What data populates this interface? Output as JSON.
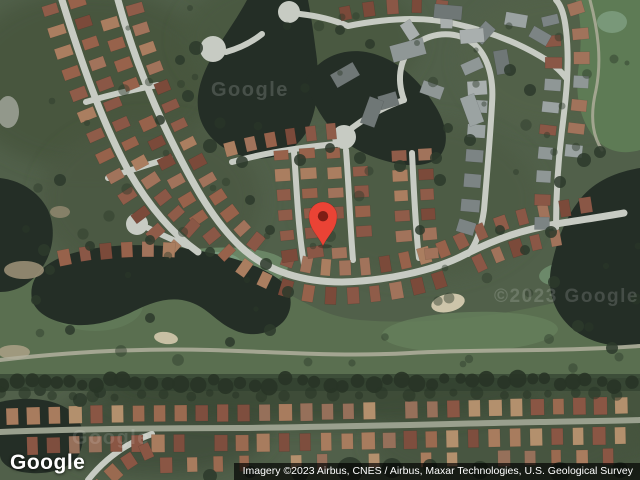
{
  "ui": {
    "logo": {
      "text": "Google"
    },
    "attribution": {
      "text": "Imagery ©2023 Airbus, CNES / Airbus, Maxar Technologies, U.S. Geological Survey"
    },
    "watermarks": [
      {
        "text": "Google",
        "x": 211,
        "y": 79,
        "size": 20,
        "opacity": 0.16
      },
      {
        "text": "©2023 Google",
        "x": 494,
        "y": 286,
        "size": 19,
        "opacity": 0.15
      },
      {
        "text": "Google",
        "x": 72,
        "y": 427,
        "size": 20,
        "opacity": 0.12
      }
    ]
  },
  "map": {
    "provider": "Google",
    "view": "satellite",
    "imagery_year": "2023",
    "marker": {
      "x": 323,
      "y": 216,
      "tip_y": 246,
      "color": "#EA4335",
      "core": "#7E1D15"
    },
    "colors": {
      "base": "#51604a",
      "road": "#c7cbc3",
      "water": "#242e26",
      "golf": "#5a6f50",
      "treeline": "#283426",
      "tree": "#2d3a2b"
    },
    "bgBlobs": [
      {
        "cx": 90,
        "cy": 80,
        "rx": 130,
        "ry": 90,
        "fill": "#47553e"
      },
      {
        "cx": 300,
        "cy": 40,
        "rx": 120,
        "ry": 70,
        "fill": "#4a5841"
      },
      {
        "cx": 560,
        "cy": 60,
        "rx": 100,
        "ry": 70,
        "fill": "#53624a"
      },
      {
        "cx": 420,
        "cy": 200,
        "rx": 120,
        "ry": 80,
        "fill": "#4d5c45"
      },
      {
        "cx": 150,
        "cy": 200,
        "rx": 110,
        "ry": 80,
        "fill": "#4b5943"
      },
      {
        "cx": 600,
        "cy": 420,
        "rx": 90,
        "ry": 55,
        "fill": "#44523d"
      },
      {
        "cx": 160,
        "cy": 430,
        "rx": 110,
        "ry": 45,
        "fill": "#404e3a"
      },
      {
        "cx": 500,
        "cy": 445,
        "rx": 130,
        "ry": 45,
        "fill": "#46543f"
      },
      {
        "cx": 320,
        "cy": 390,
        "rx": 220,
        "ry": 35,
        "fill": "#3b4835"
      }
    ],
    "golfBand": "M0,274 C60,264 120,260 180,264 C240,270 268,282 296,298 C318,310 336,318 360,320 C420,325 480,318 530,308 C570,300 606,291 640,286 L640,378 L0,378 Z",
    "golfStrip": "M576,0 L640,0 L640,150 C620,156 601,150 589,130 C578,112 575,90 579,64 C582,40 581,18 576,0 Z",
    "fairways": [
      {
        "cx": 210,
        "cy": 272,
        "rx": 78,
        "ry": 24,
        "rot": -4,
        "fill": "#6d8968",
        "op": 0.9
      },
      {
        "cx": 470,
        "cy": 332,
        "rx": 88,
        "ry": 20,
        "rot": -2,
        "fill": "#65805b",
        "op": 0.8
      },
      {
        "cx": 95,
        "cy": 305,
        "rx": 48,
        "ry": 26,
        "rot": 0,
        "fill": "#627a59",
        "op": 0.8
      },
      {
        "cx": 565,
        "cy": 274,
        "rx": 26,
        "ry": 12,
        "rot": -6,
        "fill": "#6f8e6e",
        "op": 0.9
      },
      {
        "cx": 205,
        "cy": 265,
        "rx": 36,
        "ry": 13,
        "rot": -4,
        "fill": "#7a9b7d",
        "op": 0.9
      },
      {
        "cx": 612,
        "cy": 22,
        "rx": 15,
        "ry": 11,
        "rot": 0,
        "fill": "#7a9a7b",
        "op": 0.95
      }
    ],
    "water": [
      "M247,0 C230,32 202,62 198,96 C195,125 213,147 242,156 C270,164 297,153 309,127 C318,106 320,80 316,52 C313,28 310,10 308,0 Z",
      "M306,80 C318,58 342,48 366,52 C394,57 418,78 434,104 C446,122 451,144 439,157 C425,170 397,166 371,156 C347,147 329,130 317,108 C311,97 306,88 306,80 Z",
      "M640,168 C615,172 592,182 578,202 C564,220 556,244 551,268 C547,292 554,314 574,330 C594,345 618,348 640,344 Z",
      "M0,178 C18,180 38,190 48,210 C56,228 54,250 42,268 C30,286 14,292 0,292 Z",
      "M32,300 C28,278 44,262 70,254 C102,244 152,242 195,250 C232,256 262,266 281,281 C293,291 294,310 283,322 C271,334 251,338 234,330 C216,322 208,308 190,302 C170,295 150,303 132,312 C114,321 90,328 68,324 C48,320 36,312 32,300 Z",
      "M0,402 C25,396 55,398 72,412 C84,422 86,442 78,456 C68,470 45,476 22,472 C8,469 0,462 0,455 Z"
    ],
    "sand": [
      {
        "cx": 448,
        "cy": 303,
        "rx": 17,
        "ry": 9,
        "rot": -12,
        "fill": "#cdc5aa",
        "op": 1
      },
      {
        "cx": 166,
        "cy": 338,
        "rx": 12,
        "ry": 6,
        "rot": 8,
        "fill": "#c8c0a4",
        "op": 1
      },
      {
        "cx": 24,
        "cy": 270,
        "rx": 20,
        "ry": 9,
        "rot": 0,
        "fill": "#a79a80",
        "op": 0.8
      },
      {
        "cx": 14,
        "cy": 352,
        "rx": 16,
        "ry": 7,
        "rot": 0,
        "fill": "#b0a489",
        "op": 0.8
      },
      {
        "cx": 8,
        "cy": 112,
        "rx": 11,
        "ry": 16,
        "rot": 0,
        "fill": "#9aa094",
        "op": 0.9
      },
      {
        "cx": 60,
        "cy": 212,
        "rx": 10,
        "ry": 6,
        "rot": 0,
        "fill": "#9f9278",
        "op": 0.7
      }
    ],
    "cartPaths": [
      {
        "d": "M0,360 C70,352 140,348 210,350 C280,352 340,357 410,353 C480,349 560,352 640,346",
        "w": 4,
        "c": "#b2b09d",
        "op": 0.85
      },
      {
        "d": "M590,0 C598,30 602,60 596,90 C590,115 592,135 602,150",
        "w": 3,
        "c": "#b2b09d",
        "op": 0.8
      }
    ],
    "palettes": {
      "brown": [
        "#8a5746",
        "#97624b",
        "#7b4a3a",
        "#a1735b",
        "#8f5c49",
        "#aa7e60"
      ],
      "brownTan": [
        "#9a6a50",
        "#a87c5e",
        "#8a5644",
        "#b3906d",
        "#7e4e3e",
        "#96705a"
      ],
      "gray": [
        "#8f9796",
        "#9ba3a2",
        "#7c8484",
        "#a9afae",
        "#6f7776"
      ],
      "grayBrown": [
        "#8f9796",
        "#97624b",
        "#9ba3a2",
        "#8a5746",
        "#7c8484",
        "#a1735b"
      ]
    },
    "roads": [
      {
        "d": "M118,0 C132,52 152,102 174,146 C194,186 214,222 242,248 C268,272 304,282 342,282 C382,281 432,272 466,254 C498,238 522,230 556,224 C580,220 602,217 624,213",
        "w": 7,
        "houses": [
          {
            "off": -14,
            "spacing": 21,
            "size": [
              11,
              16
            ],
            "palette": "brown",
            "range": [
              0.02,
              0.97
            ]
          },
          {
            "off": 14,
            "spacing": 21,
            "size": [
              11,
              16
            ],
            "palette": "brown",
            "range": [
              0.03,
              0.9
            ]
          }
        ]
      },
      {
        "d": "M62,0 C80,58 100,118 128,170 C147,203 170,232 198,252",
        "w": 7,
        "houses": [
          {
            "off": -14,
            "spacing": 22,
            "size": [
              11,
              16
            ],
            "palette": "brown",
            "range": [
              0.02,
              0.95
            ]
          },
          {
            "off": 14,
            "spacing": 22,
            "size": [
              11,
              16
            ],
            "palette": "brown",
            "range": [
              0.02,
              0.95
            ]
          }
        ]
      },
      {
        "d": "M86,102 C112,94 136,89 158,85",
        "w": 6
      },
      {
        "d": "M108,178 C130,170 150,164 170,158",
        "w": 6
      },
      {
        "d": "M188,246 C172,240 158,233 148,228",
        "w": 6
      },
      {
        "d": "M226,52 C240,48 252,42 262,34",
        "w": 6
      },
      {
        "d": "M300,14 C318,16 334,20 348,26",
        "w": 6
      },
      {
        "d": "M348,26 C388,18 424,16 456,24 C488,31 516,42 540,56 C552,63 560,70 566,78",
        "w": 6,
        "houses": [
          {
            "off": -13,
            "spacing": 23,
            "size": [
              11,
              15
            ],
            "palette": "brown",
            "range": [
              0,
              0.4
            ]
          }
        ]
      },
      {
        "d": "M294,152 C297,192 298,228 304,264",
        "w": 6,
        "houses": [
          {
            "off": -13,
            "spacing": 20,
            "size": [
              11,
              15
            ],
            "palette": "brown"
          },
          {
            "off": 13,
            "spacing": 20,
            "size": [
              11,
              15
            ],
            "palette": "brown"
          }
        ]
      },
      {
        "d": "M346,150 C349,188 350,224 353,260",
        "w": 6,
        "houses": [
          {
            "off": -13,
            "spacing": 20,
            "size": [
              11,
              15
            ],
            "palette": "brown"
          },
          {
            "off": 13,
            "spacing": 20,
            "size": [
              11,
              15
            ],
            "palette": "brown"
          }
        ]
      },
      {
        "d": "M232,162 C268,152 304,147 336,144",
        "w": 6,
        "houses": [
          {
            "off": -13,
            "spacing": 20,
            "size": [
              11,
              15
            ],
            "palette": "brown"
          }
        ]
      },
      {
        "d": "M412,153 C414,190 415,224 419,258",
        "w": 6,
        "houses": [
          {
            "off": -13,
            "spacing": 20,
            "size": [
              11,
              15
            ],
            "palette": "brown"
          },
          {
            "off": 13,
            "spacing": 20,
            "size": [
              11,
              15
            ],
            "palette": "brown"
          }
        ]
      },
      {
        "d": "M352,128 C368,116 386,106 404,100",
        "w": 6
      },
      {
        "d": "M404,100 C396,78 400,56 416,44 C434,31 458,31 474,44 C488,56 494,78 492,104",
        "w": 6,
        "houses": [
          {
            "off": 15,
            "spacing": 28,
            "size": [
              13,
              19
            ],
            "palette": "gray",
            "p": 0.8
          },
          {
            "off": -15,
            "spacing": 30,
            "size": [
              13,
              19
            ],
            "palette": "gray",
            "p": 0.6
          }
        ]
      },
      {
        "d": "M492,104 C490,140 487,175 484,210 C481,232 475,246 468,254",
        "w": 6,
        "houses": [
          {
            "off": 14,
            "spacing": 25,
            "size": [
              12,
              18
            ],
            "palette": "gray"
          }
        ]
      },
      {
        "d": "M556,228 C556,196 558,162 562,130 C566,98 570,64 566,30 C564,12 560,4 556,0",
        "w": 6,
        "houses": [
          {
            "off": -14,
            "spacing": 23,
            "size": [
              11,
              16
            ],
            "palette": "grayBrown"
          },
          {
            "off": 14,
            "spacing": 23,
            "size": [
              11,
              16
            ],
            "palette": "grayBrown",
            "range": [
              0.34,
              1
            ]
          }
        ]
      },
      {
        "d": "M0,432 C80,429 160,428 240,428 C340,427 440,424 540,422 C580,421 612,421 640,420",
        "w": 6,
        "color": "#9aa08e",
        "houses": [
          {
            "off": -15,
            "spacing": 21,
            "size": [
              12,
              17
            ],
            "palette": "brownTan"
          },
          {
            "off": 15,
            "spacing": 21,
            "size": [
              12,
              17
            ],
            "palette": "brownTan",
            "range": [
              0.05,
              1
            ]
          }
        ]
      },
      {
        "d": "M88,480 C104,460 124,444 152,434",
        "w": 6,
        "houses": [
          {
            "off": 14,
            "spacing": 22,
            "size": [
              11,
              15
            ],
            "palette": "brownTan"
          }
        ]
      },
      {
        "d": "M130,466 C300,462 470,459 640,456",
        "w": 0,
        "houses": [
          {
            "off": 0,
            "spacing": 26,
            "size": [
              11,
              15
            ],
            "palette": "brownTan",
            "p": 0.72
          }
        ]
      },
      {
        "d": "M62,258 C100,250 140,247 186,251",
        "w": 0,
        "houses": [
          {
            "off": 0,
            "spacing": 21,
            "size": [
              11,
              15
            ],
            "palette": "brown",
            "p": 0.95
          }
        ]
      }
    ],
    "courts": [
      {
        "cx": 137,
        "cy": 224,
        "r": 11
      },
      {
        "cx": 213,
        "cy": 49,
        "r": 13
      },
      {
        "cx": 289,
        "cy": 12,
        "r": 11
      },
      {
        "cx": 344,
        "cy": 137,
        "r": 12
      }
    ],
    "buildings": [
      {
        "x": 345,
        "y": 75,
        "w": 26,
        "h": 15,
        "rot": -30
      },
      {
        "x": 408,
        "y": 50,
        "w": 34,
        "h": 17,
        "rot": -15
      },
      {
        "x": 448,
        "y": 12,
        "w": 28,
        "h": 14,
        "rot": 5
      },
      {
        "x": 472,
        "y": 36,
        "w": 24,
        "h": 14,
        "rot": -5
      },
      {
        "x": 372,
        "y": 112,
        "w": 28,
        "h": 15,
        "rot": -70
      },
      {
        "x": 472,
        "y": 110,
        "w": 30,
        "h": 15,
        "rot": 70
      },
      {
        "x": 432,
        "y": 90,
        "w": 22,
        "h": 13,
        "rot": 20
      },
      {
        "x": 502,
        "y": 62,
        "w": 24,
        "h": 14,
        "rot": 80
      },
      {
        "x": 516,
        "y": 20,
        "w": 22,
        "h": 13,
        "rot": 10
      },
      {
        "x": 540,
        "y": 36,
        "w": 20,
        "h": 12,
        "rot": 30
      }
    ],
    "treeClusters": [
      [
        196,
        48,
        7
      ],
      [
        188,
        96,
        6
      ],
      [
        210,
        146,
        7
      ],
      [
        242,
        162,
        6
      ],
      [
        300,
        160,
        6
      ],
      [
        330,
        148,
        5
      ],
      [
        360,
        158,
        6
      ],
      [
        400,
        166,
        6
      ],
      [
        436,
        158,
        6
      ],
      [
        448,
        128,
        5
      ],
      [
        370,
        44,
        5
      ],
      [
        340,
        30,
        5
      ],
      [
        560,
        182,
        6
      ],
      [
        551,
        232,
        6
      ],
      [
        554,
        282,
        6
      ],
      [
        578,
        326,
        6
      ],
      [
        612,
        348,
        6
      ],
      [
        584,
        160,
        7
      ],
      [
        600,
        152,
        6
      ],
      [
        44,
        250,
        6
      ],
      [
        90,
        246,
        5
      ],
      [
        150,
        240,
        5
      ],
      [
        210,
        252,
        5
      ],
      [
        266,
        264,
        6
      ],
      [
        288,
        292,
        6
      ],
      [
        270,
        330,
        6
      ],
      [
        230,
        342,
        5
      ],
      [
        150,
        318,
        5
      ],
      [
        70,
        330,
        5
      ],
      [
        36,
        300,
        5
      ],
      [
        60,
        180,
        6
      ],
      [
        50,
        270,
        5
      ],
      [
        80,
        400,
        7
      ],
      [
        40,
        390,
        6
      ],
      [
        100,
        392,
        6
      ],
      [
        350,
        470,
        13
      ],
      [
        392,
        468,
        10
      ],
      [
        300,
        474,
        8
      ],
      [
        480,
        470,
        9
      ],
      [
        560,
        472,
        10
      ],
      [
        620,
        470,
        8
      ],
      [
        210,
        476,
        7
      ],
      [
        250,
        472,
        6
      ],
      [
        430,
        466,
        7
      ],
      [
        510,
        70,
        6
      ],
      [
        530,
        90,
        6
      ],
      [
        470,
        140,
        6
      ],
      [
        440,
        180,
        6
      ],
      [
        420,
        230,
        5
      ],
      [
        500,
        230,
        5
      ],
      [
        525,
        250,
        5
      ],
      [
        180,
        60,
        5
      ],
      [
        160,
        120,
        5
      ],
      [
        250,
        200,
        5
      ],
      [
        270,
        230,
        5
      ]
    ]
  }
}
